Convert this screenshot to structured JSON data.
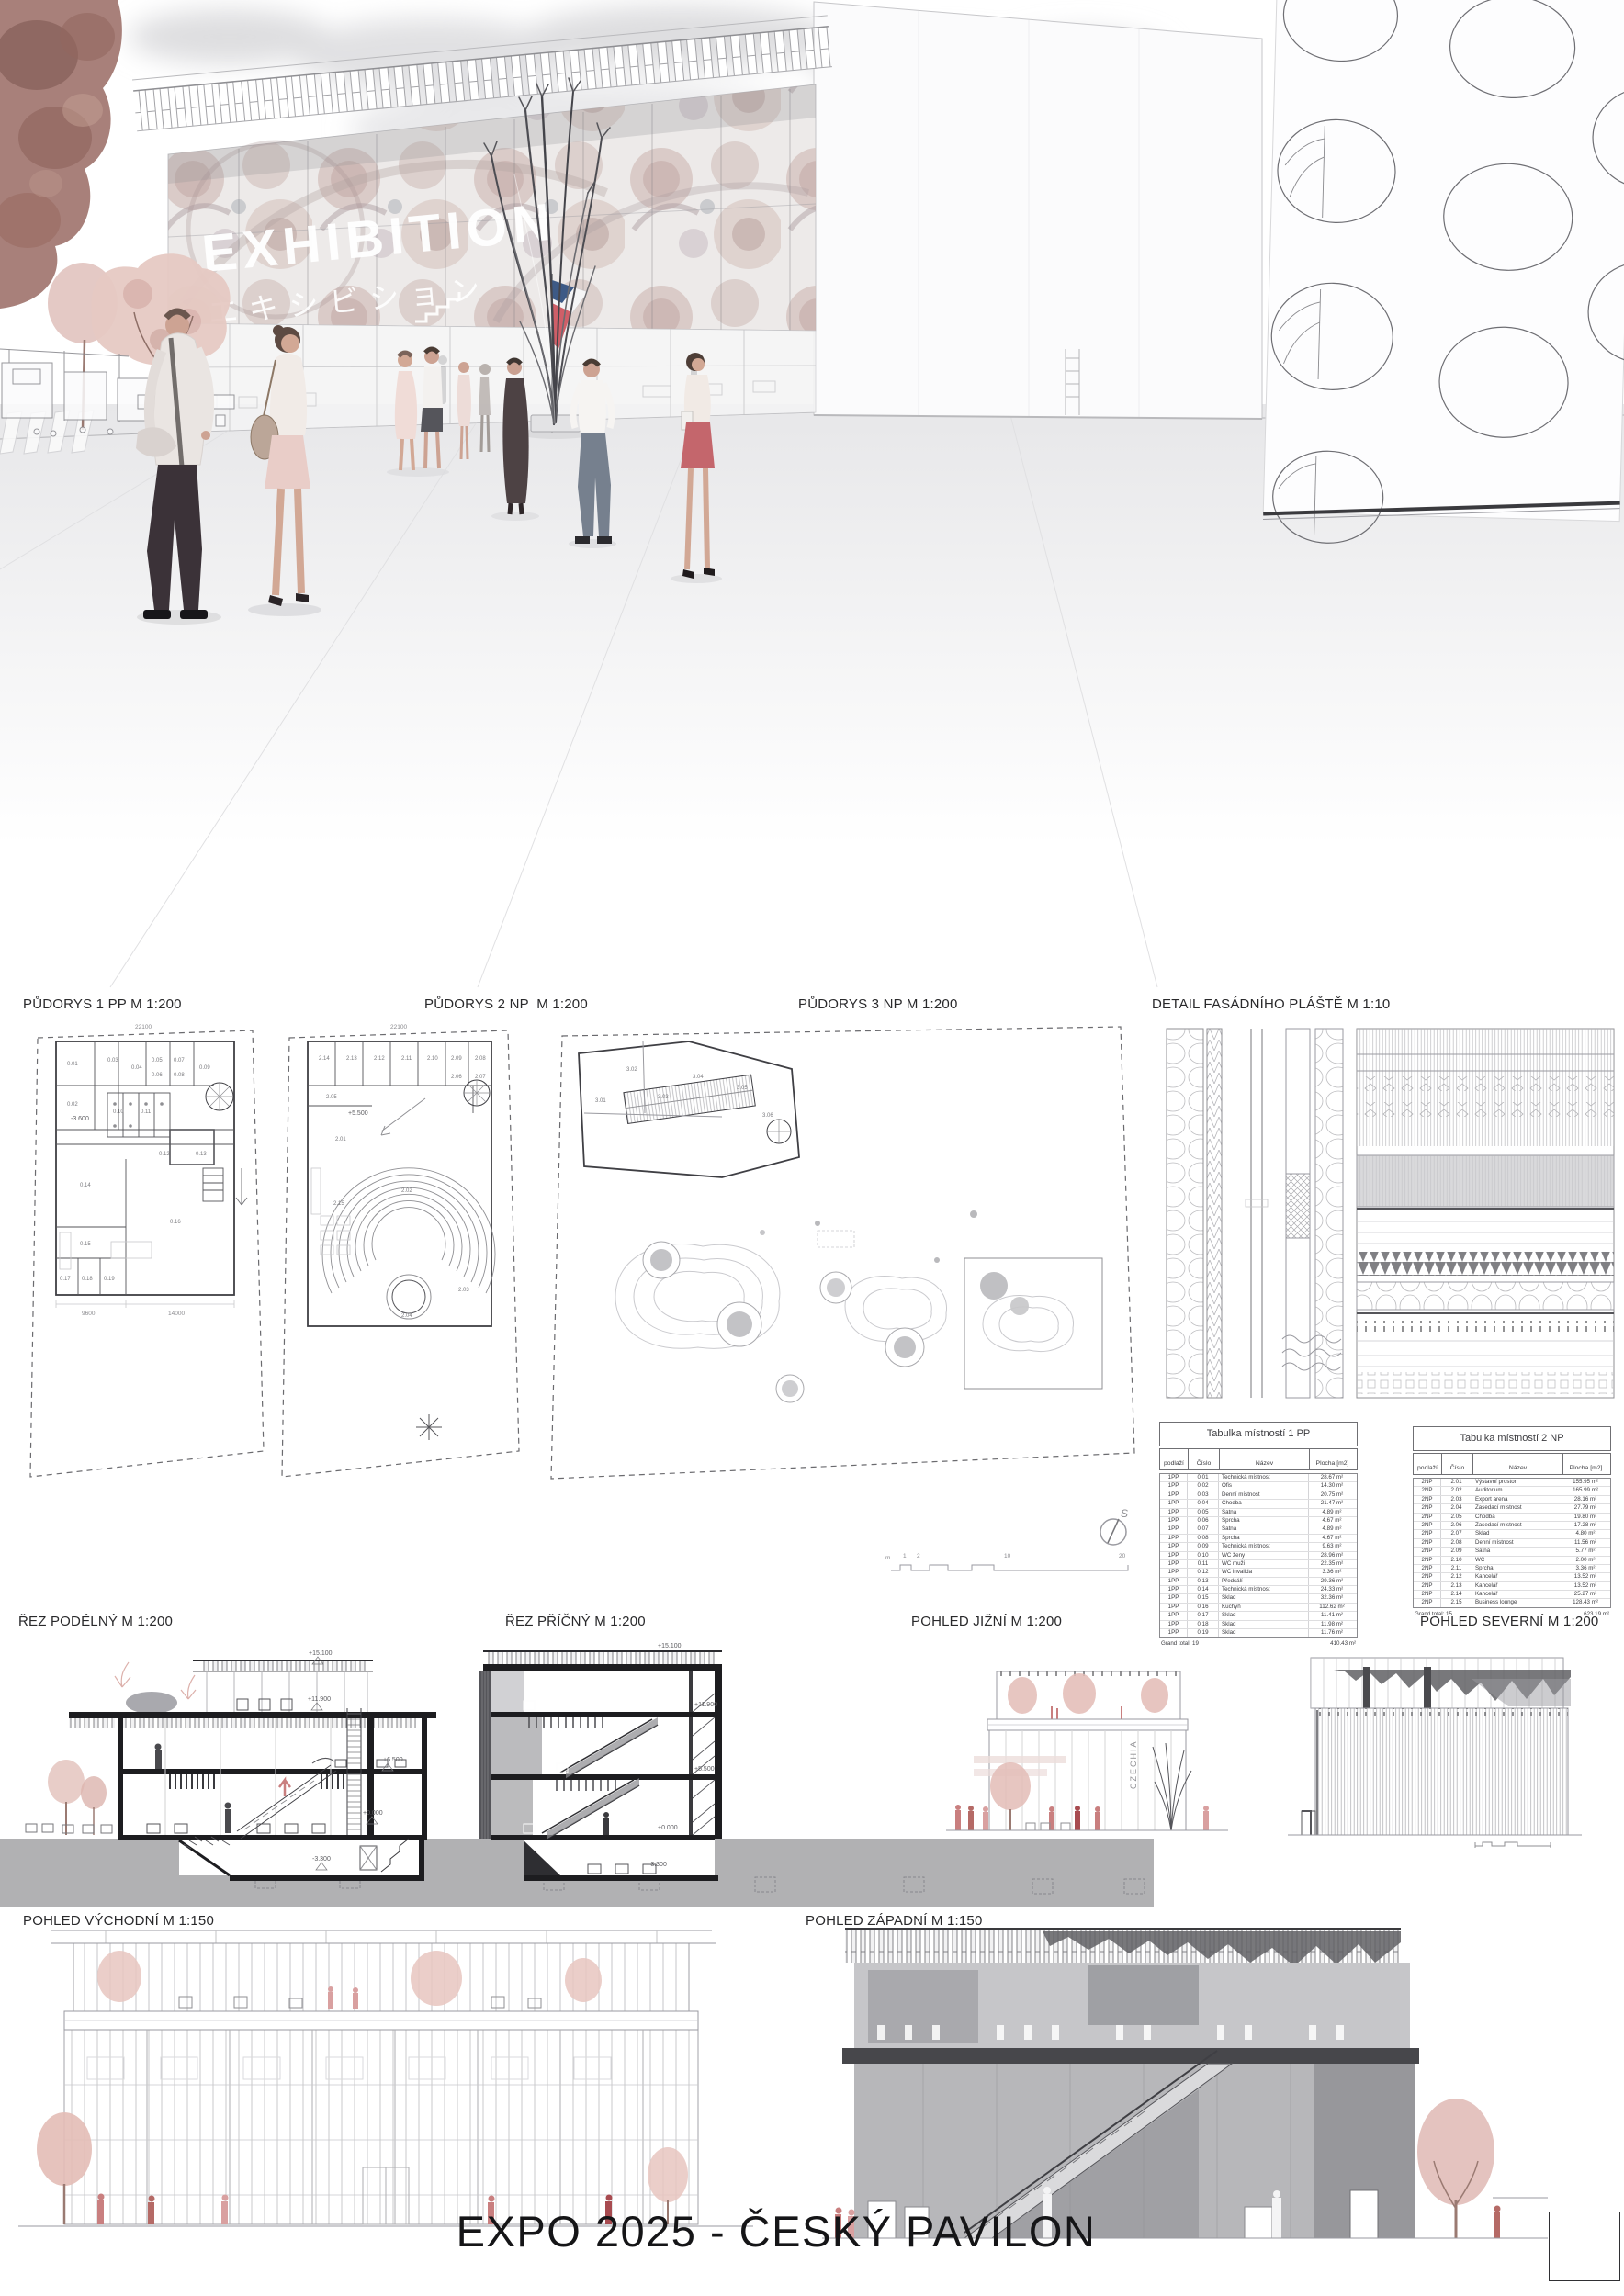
{
  "board": {
    "title": "EXPO 2025 - ČESKÝ PAVILON"
  },
  "hero": {
    "billboard_title": "EXHIBITION",
    "billboard_subtitle": "エキシビション",
    "flag": {
      "blue": "#3d5a86",
      "red": "#cf5f68",
      "white": "#f4f4f4"
    }
  },
  "labels": {
    "plan1": "PŮDORYS 1 PP M 1:200",
    "plan2": "PŮDORYS 2 NP  M 1:200",
    "plan3": "PŮDORYS 3 NP M 1:200",
    "facade_detail": "DETAIL FASÁDNÍHO PLÁŠTĚ M 1:10",
    "section_long": "ŘEZ PODÉLNÝ M 1:200",
    "section_cross": "ŘEZ PŘÍČNÝ M 1:200",
    "elevation_south": "POHLED JIŽNÍ M 1:200",
    "elevation_north": "POHLED SEVERNÍ M 1:200",
    "elevation_east": "POHLED VÝCHODNÍ M 1:150",
    "elevation_west": "POHLED ZÁPADNÍ M 1:150"
  },
  "plans": {
    "p1": {
      "level_mark": "-3.600",
      "dim_top": "22100",
      "dim_left": "9600",
      "dim_right": "14000",
      "rooms": [
        "0.01",
        "0.02",
        "0.03",
        "0.04",
        "0.05",
        "0.06",
        "0.07",
        "0.08",
        "0.09",
        "0.10",
        "0.11",
        "0.12",
        "0.13",
        "0.14",
        "0.15",
        "0.16",
        "0.17",
        "0.18",
        "0.19"
      ]
    },
    "p2": {
      "level_mark": "+5.500",
      "dim_top": "22100",
      "rooms": [
        "2.01",
        "2.02",
        "2.03",
        "2.04",
        "2.05",
        "2.06",
        "2.07",
        "2.08",
        "2.09",
        "2.10",
        "2.11",
        "2.12",
        "2.13",
        "2.14",
        "2.15"
      ]
    },
    "p3": {
      "rooms": [
        "3.01",
        "3.02",
        "3.03",
        "3.04",
        "3.05",
        "3.06"
      ]
    },
    "north_mark": "S",
    "scalebar": [
      "m",
      "1",
      "2",
      "10",
      "20"
    ]
  },
  "sections_marks": {
    "long": [
      "+15.100",
      "+11.900",
      "+6.500",
      "+0.000",
      "-3.300"
    ],
    "cross": [
      "+15.100",
      "+11.900",
      "+5.500",
      "+0.000",
      "-3.300"
    ]
  },
  "south_elevation": {
    "facade_text": "CZECHIA"
  },
  "tables": {
    "t1pp": {
      "title": "Tabulka místností 1 PP",
      "headers": [
        "podlaží",
        "Číslo",
        "Název",
        "Plocha [m2]"
      ],
      "rows": [
        {
          "f": "1PP",
          "n": "0.01",
          "name": "Technická místnost",
          "a": "28.67 m²"
        },
        {
          "f": "1PP",
          "n": "0.02",
          "name": "Ofis",
          "a": "14.30 m²"
        },
        {
          "f": "1PP",
          "n": "0.03",
          "name": "Denní místnost",
          "a": "20.75 m²"
        },
        {
          "f": "1PP",
          "n": "0.04",
          "name": "Chodba",
          "a": "21.47 m²"
        },
        {
          "f": "1PP",
          "n": "0.05",
          "name": "Šatna",
          "a": "4.89 m²"
        },
        {
          "f": "1PP",
          "n": "0.06",
          "name": "Sprcha",
          "a": "4.67 m²"
        },
        {
          "f": "1PP",
          "n": "0.07",
          "name": "Šatna",
          "a": "4.89 m²"
        },
        {
          "f": "1PP",
          "n": "0.08",
          "name": "Sprcha",
          "a": "4.67 m²"
        },
        {
          "f": "1PP",
          "n": "0.09",
          "name": "Technická místnost",
          "a": "9.63 m²"
        },
        {
          "f": "1PP",
          "n": "0.10",
          "name": "WC ženy",
          "a": "28.96 m²"
        },
        {
          "f": "1PP",
          "n": "0.11",
          "name": "WC muži",
          "a": "22.35 m²"
        },
        {
          "f": "1PP",
          "n": "0.12",
          "name": "WC invalida",
          "a": "3.36 m²"
        },
        {
          "f": "1PP",
          "n": "0.13",
          "name": "Předsálí",
          "a": "29.36 m²"
        },
        {
          "f": "1PP",
          "n": "0.14",
          "name": "Technická místnost",
          "a": "24.33 m²"
        },
        {
          "f": "1PP",
          "n": "0.15",
          "name": "Sklad",
          "a": "32.36 m²"
        },
        {
          "f": "1PP",
          "n": "0.16",
          "name": "Kuchyň",
          "a": "112.62 m²"
        },
        {
          "f": "1PP",
          "n": "0.17",
          "name": "Sklad",
          "a": "11.41 m²"
        },
        {
          "f": "1PP",
          "n": "0.18",
          "name": "Sklad",
          "a": "11.98 m²"
        },
        {
          "f": "1PP",
          "n": "0.19",
          "name": "Sklad",
          "a": "11.76 m²"
        }
      ],
      "total_label": "Grand total: 19",
      "total_value": "410.43 m²"
    },
    "t2np": {
      "title": "Tabulka místností 2 NP",
      "headers": [
        "podlaží",
        "Číslo",
        "Název",
        "Plocha [m2]"
      ],
      "rows": [
        {
          "f": "2NP",
          "n": "2.01",
          "name": "Výstavní prostor",
          "a": "155.95 m²"
        },
        {
          "f": "2NP",
          "n": "2.02",
          "name": "Auditorium",
          "a": "165.99 m²"
        },
        {
          "f": "2NP",
          "n": "2.03",
          "name": "Export arena",
          "a": "28.16 m²"
        },
        {
          "f": "2NP",
          "n": "2.04",
          "name": "Zasedací místnost",
          "a": "27.79 m²"
        },
        {
          "f": "2NP",
          "n": "2.05",
          "name": "Chodba",
          "a": "19.80 m²"
        },
        {
          "f": "2NP",
          "n": "2.06",
          "name": "Zasedací místnost",
          "a": "17.28 m²"
        },
        {
          "f": "2NP",
          "n": "2.07",
          "name": "Sklad",
          "a": "4.80 m²"
        },
        {
          "f": "2NP",
          "n": "2.08",
          "name": "Denní místnost",
          "a": "11.56 m²"
        },
        {
          "f": "2NP",
          "n": "2.09",
          "name": "Šatna",
          "a": "5.77 m²"
        },
        {
          "f": "2NP",
          "n": "2.10",
          "name": "WC",
          "a": "2.00 m²"
        },
        {
          "f": "2NP",
          "n": "2.11",
          "name": "Sprcha",
          "a": "3.36 m²"
        },
        {
          "f": "2NP",
          "n": "2.12",
          "name": "Kancelář",
          "a": "13.52 m²"
        },
        {
          "f": "2NP",
          "n": "2.13",
          "name": "Kancelář",
          "a": "13.52 m²"
        },
        {
          "f": "2NP",
          "n": "2.14",
          "name": "Kancelář",
          "a": "25.27 m²"
        },
        {
          "f": "2NP",
          "n": "2.15",
          "name": "Business lounge",
          "a": "128.43 m²"
        }
      ],
      "total_label": "Grand total: 15",
      "total_value": "623.19 m²"
    }
  }
}
